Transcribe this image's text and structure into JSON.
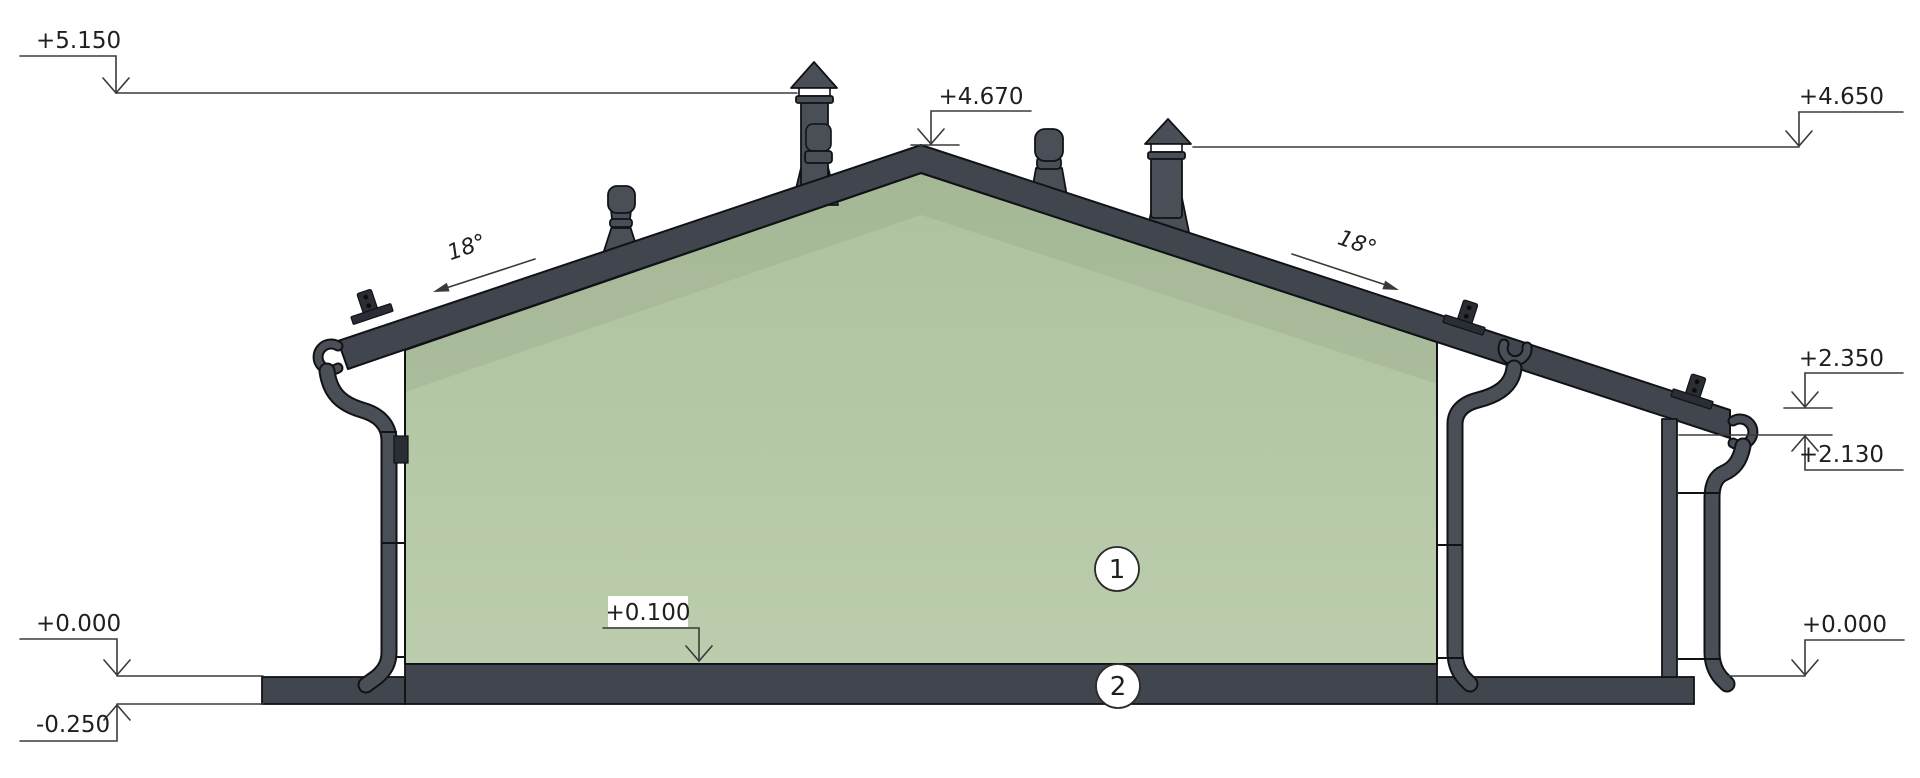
{
  "drawing": {
    "kind": "house-section-elevation"
  },
  "colors": {
    "background": "#ffffff",
    "roof": "#41454e",
    "pipe": "#4a4e57",
    "dark": "#2a2d33",
    "facade_top": "#aec29f",
    "facade_bottom": "#bbcdac",
    "outline": "#101216",
    "dimension_line": "#3a3a3a",
    "text": "#1f1f1f"
  },
  "levels": {
    "chimney_top": "+5.150",
    "ridge": "+4.670",
    "right_chimney_top": "+4.650",
    "canopy_eave_top": "+2.350",
    "canopy_eave_underside": "+2.130",
    "ground_left": "+0.000",
    "ground_right": "+0.000",
    "pavement_bottom": "-0.250",
    "finished_floor": "+0.100"
  },
  "roof_slopes": {
    "left": "18°",
    "right": "18°"
  },
  "callouts": [
    {
      "id": "1"
    },
    {
      "id": "2"
    }
  ]
}
